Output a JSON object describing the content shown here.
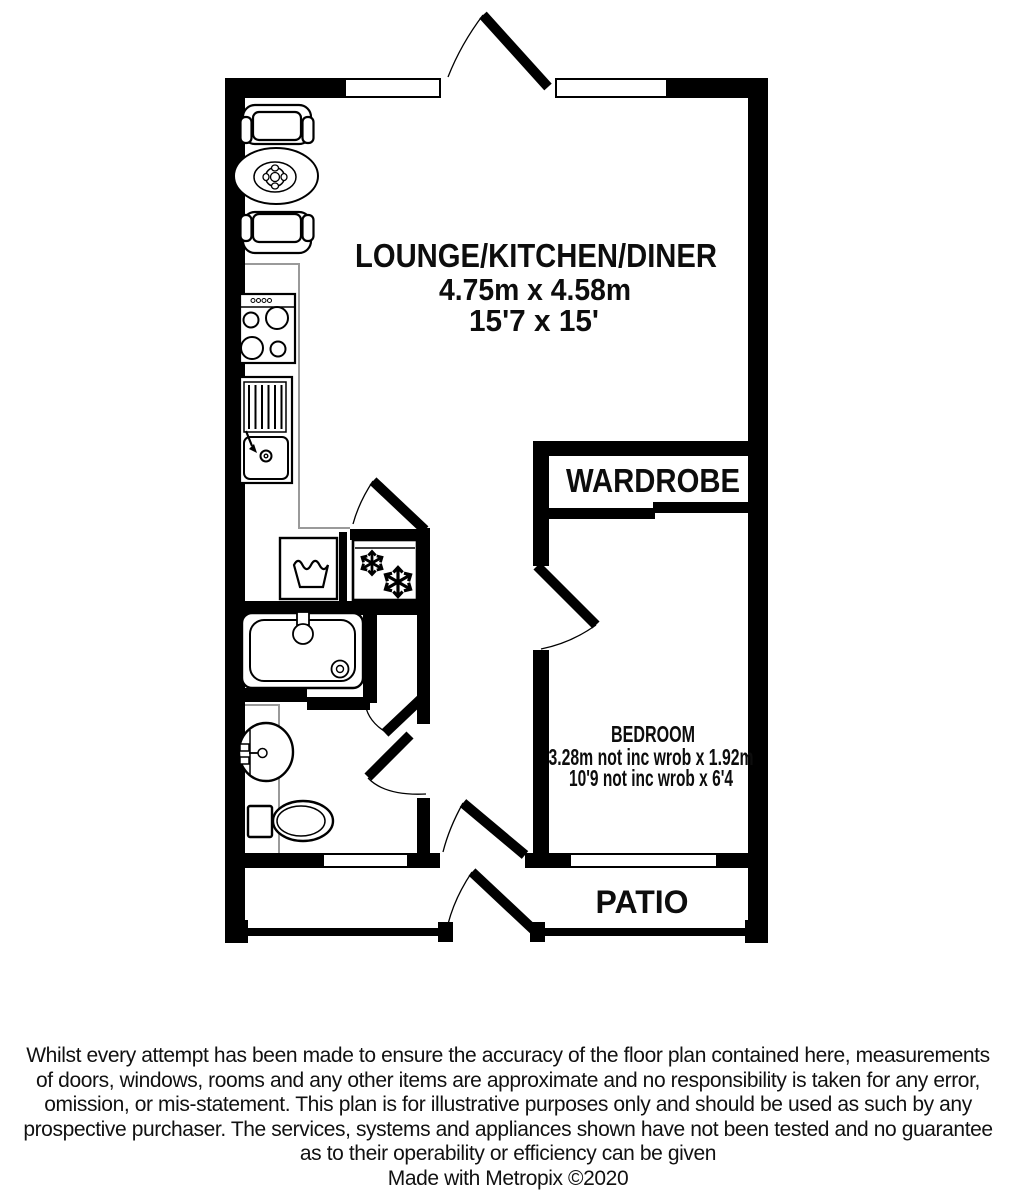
{
  "rooms": {
    "lounge": {
      "label": "LOUNGE/KITCHEN/DINER",
      "size_metric": "4.75m x 4.58m",
      "size_imperial": "15'7 x 15'"
    },
    "wardrobe": {
      "label": "WARDROBE"
    },
    "bedroom": {
      "label": "BEDROOM",
      "size_metric": "3.28m not inc wrob x 1.92m",
      "size_imperial": "10'9 not inc wrob x 6'4"
    },
    "patio": {
      "label": "PATIO"
    }
  },
  "fixtures": [
    "armchair",
    "dining-table",
    "cooker",
    "kitchen-sink",
    "washing-machine",
    "fridge-freezer",
    "bathtub",
    "washbasin",
    "toilet",
    "door-swing",
    "window"
  ],
  "colors": {
    "walls": "#000000",
    "counter_line": "#9a9a9a",
    "background": "#ffffff",
    "text": "#111111"
  },
  "footer": {
    "disclaimer_lines": [
      "Whilst every attempt has been made to ensure the accuracy of the floor plan contained here, measurements",
      "of doors, windows, rooms and any other items are approximate and no responsibility is taken for any error,",
      "omission, or mis-statement. This plan is for illustrative purposes only and should be used as such by any",
      "prospective purchaser. The services, systems and appliances shown have not been tested and no guarantee",
      "as to their operability or efficiency can be given"
    ],
    "credit": "Made with Metropix ©2020"
  }
}
